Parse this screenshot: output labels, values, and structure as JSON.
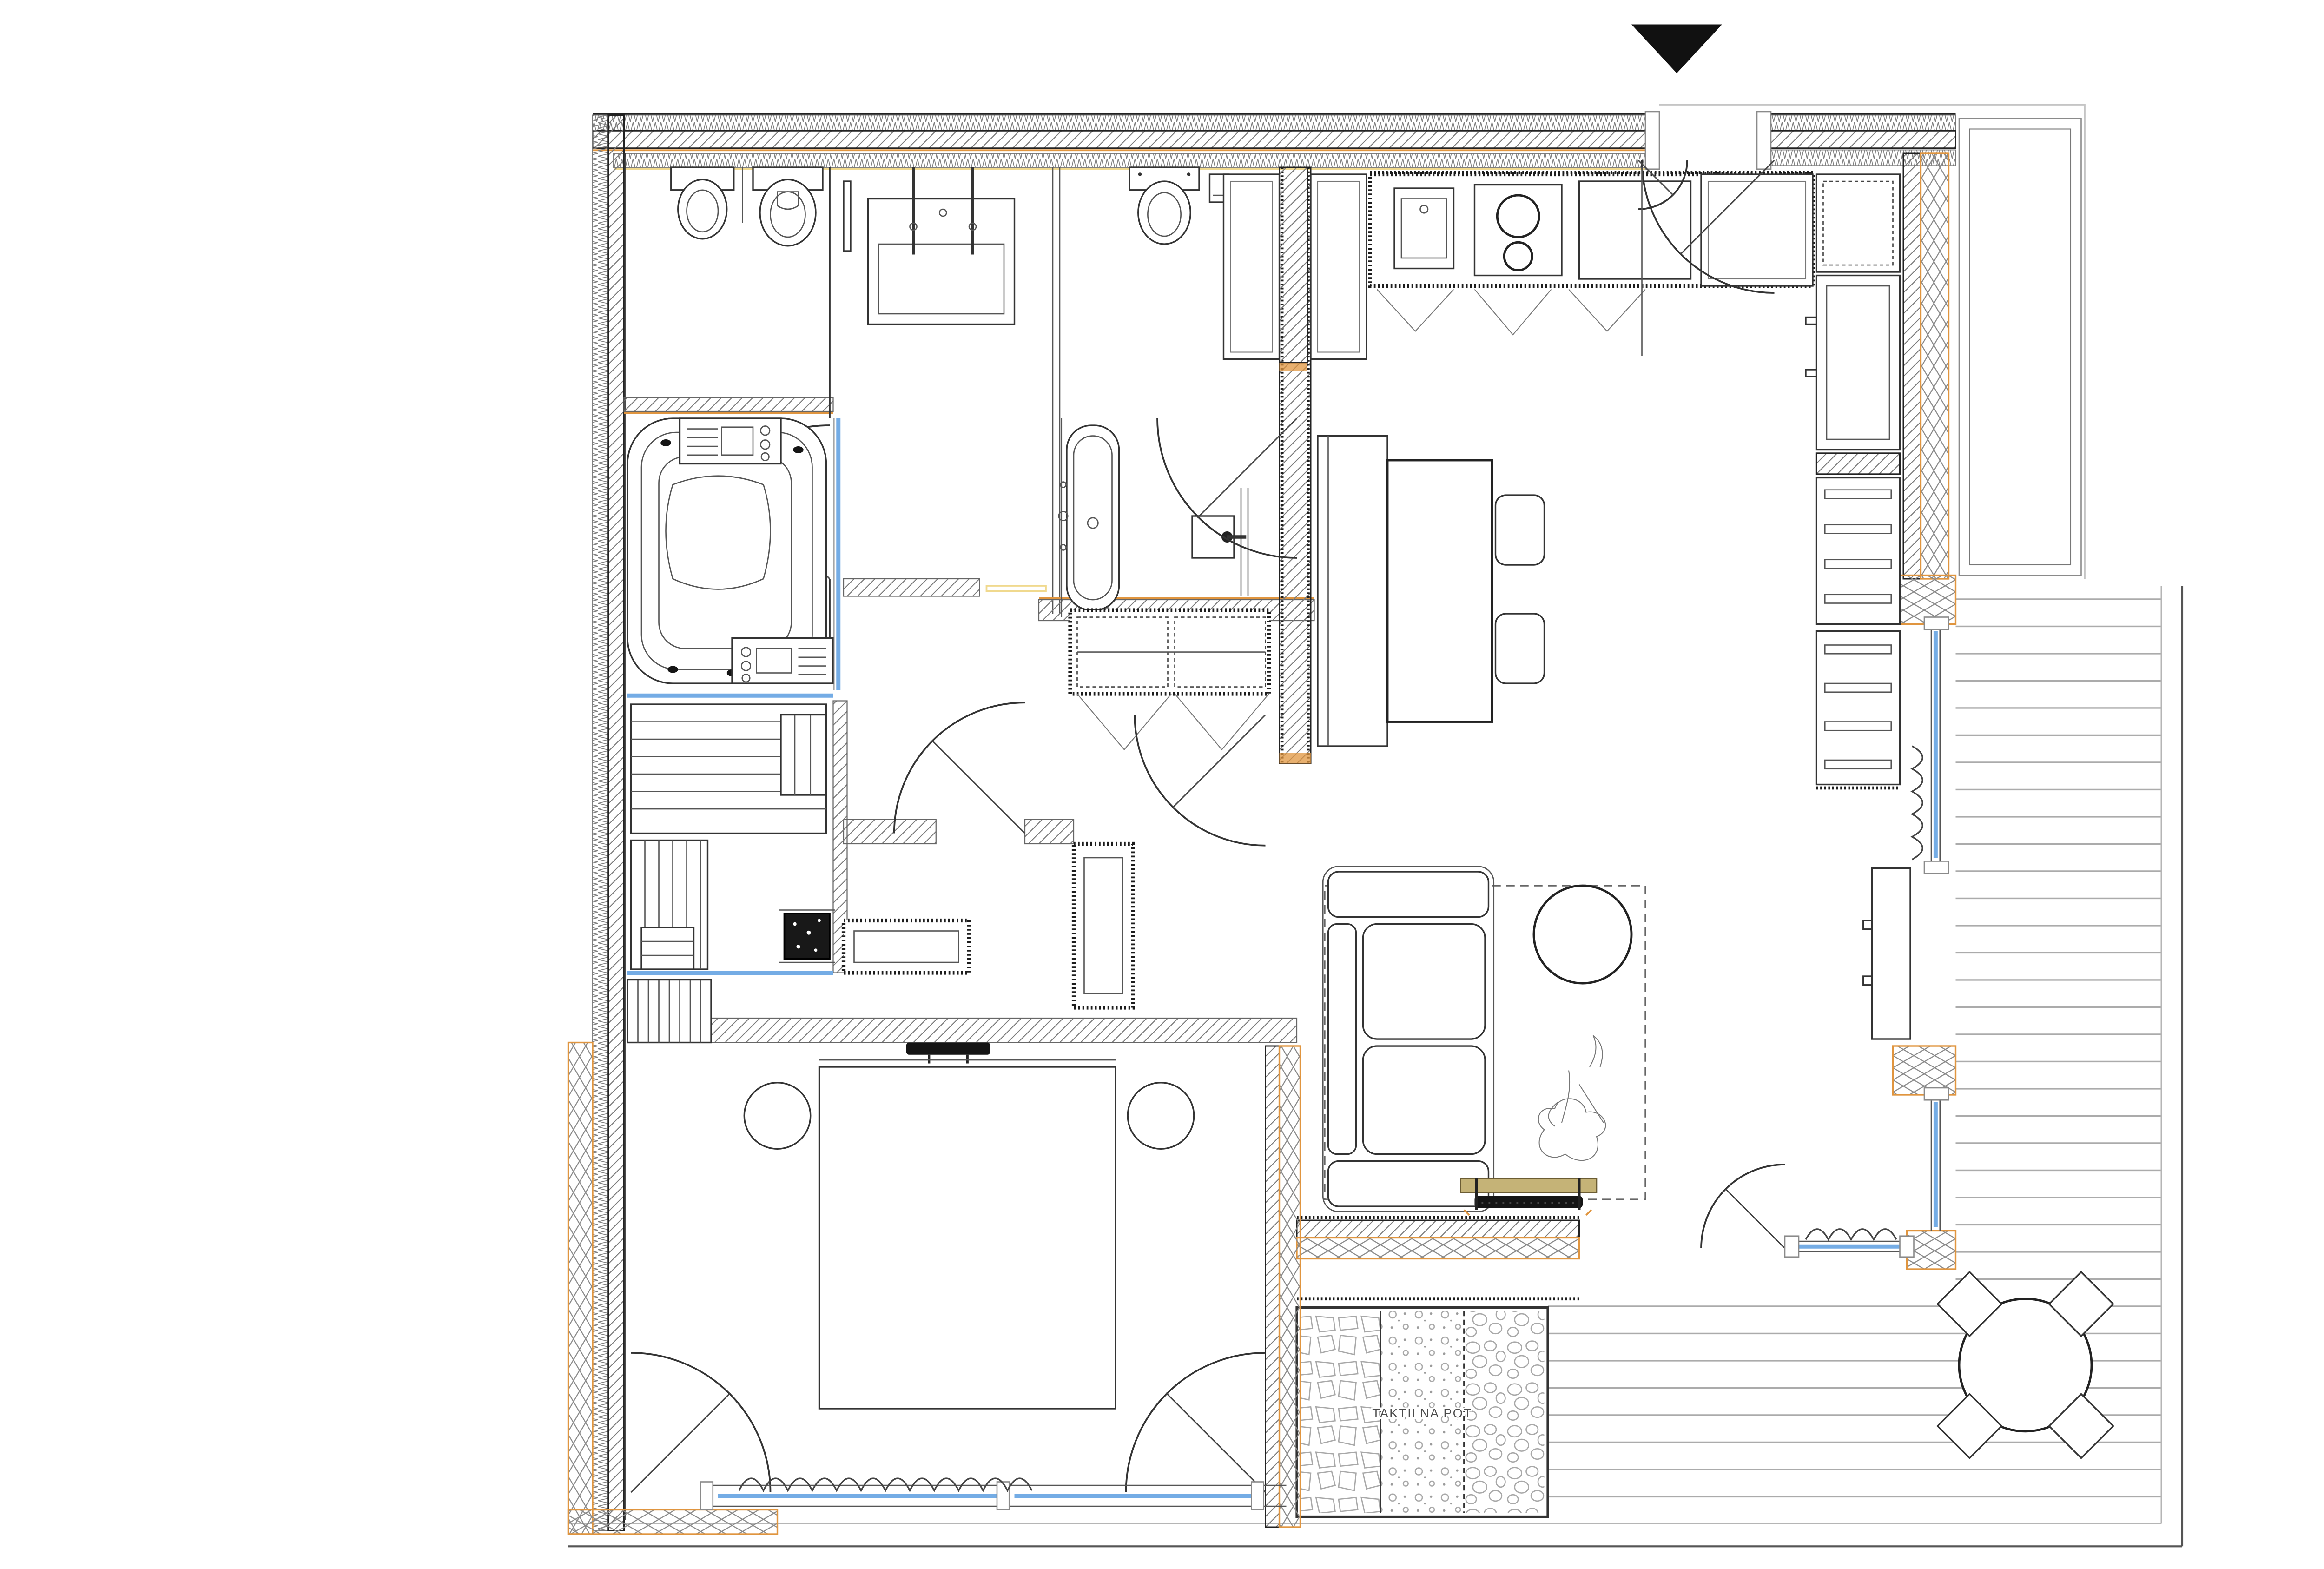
{
  "page": {
    "background": "#ffffff"
  },
  "labels": {
    "tactile_path": "TAKTILNA POT"
  },
  "north_arrow": {
    "symbol": "filled-triangle-down"
  },
  "colors": {
    "wall_hatch": "#7a7a7a",
    "line_dark": "#222222",
    "line_mid": "#555555",
    "accent_orange": "#e0953f",
    "accent_tan": "#f0d98e",
    "glass_blue": "#74ace5",
    "wood": "#c5b377",
    "deck_line": "#ababab",
    "stone_line": "#a8a8a8",
    "text_color": "#4a4a4a"
  }
}
